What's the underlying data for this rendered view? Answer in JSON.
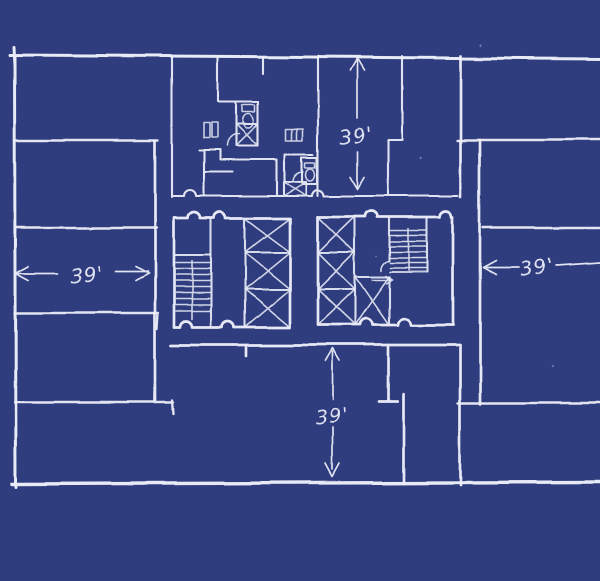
{
  "colors": {
    "background": "#2f3c7e",
    "ink": "#eef1fa"
  },
  "dimensions": {
    "top": {
      "label": "39'",
      "side": "top",
      "measures": "north lease depth"
    },
    "left": {
      "label": "39'",
      "side": "left",
      "measures": "west lease depth"
    },
    "right": {
      "label": "39'",
      "side": "right",
      "measures": "east lease depth"
    },
    "bottom": {
      "label": "39'",
      "side": "bottom",
      "measures": "south lease depth"
    }
  }
}
